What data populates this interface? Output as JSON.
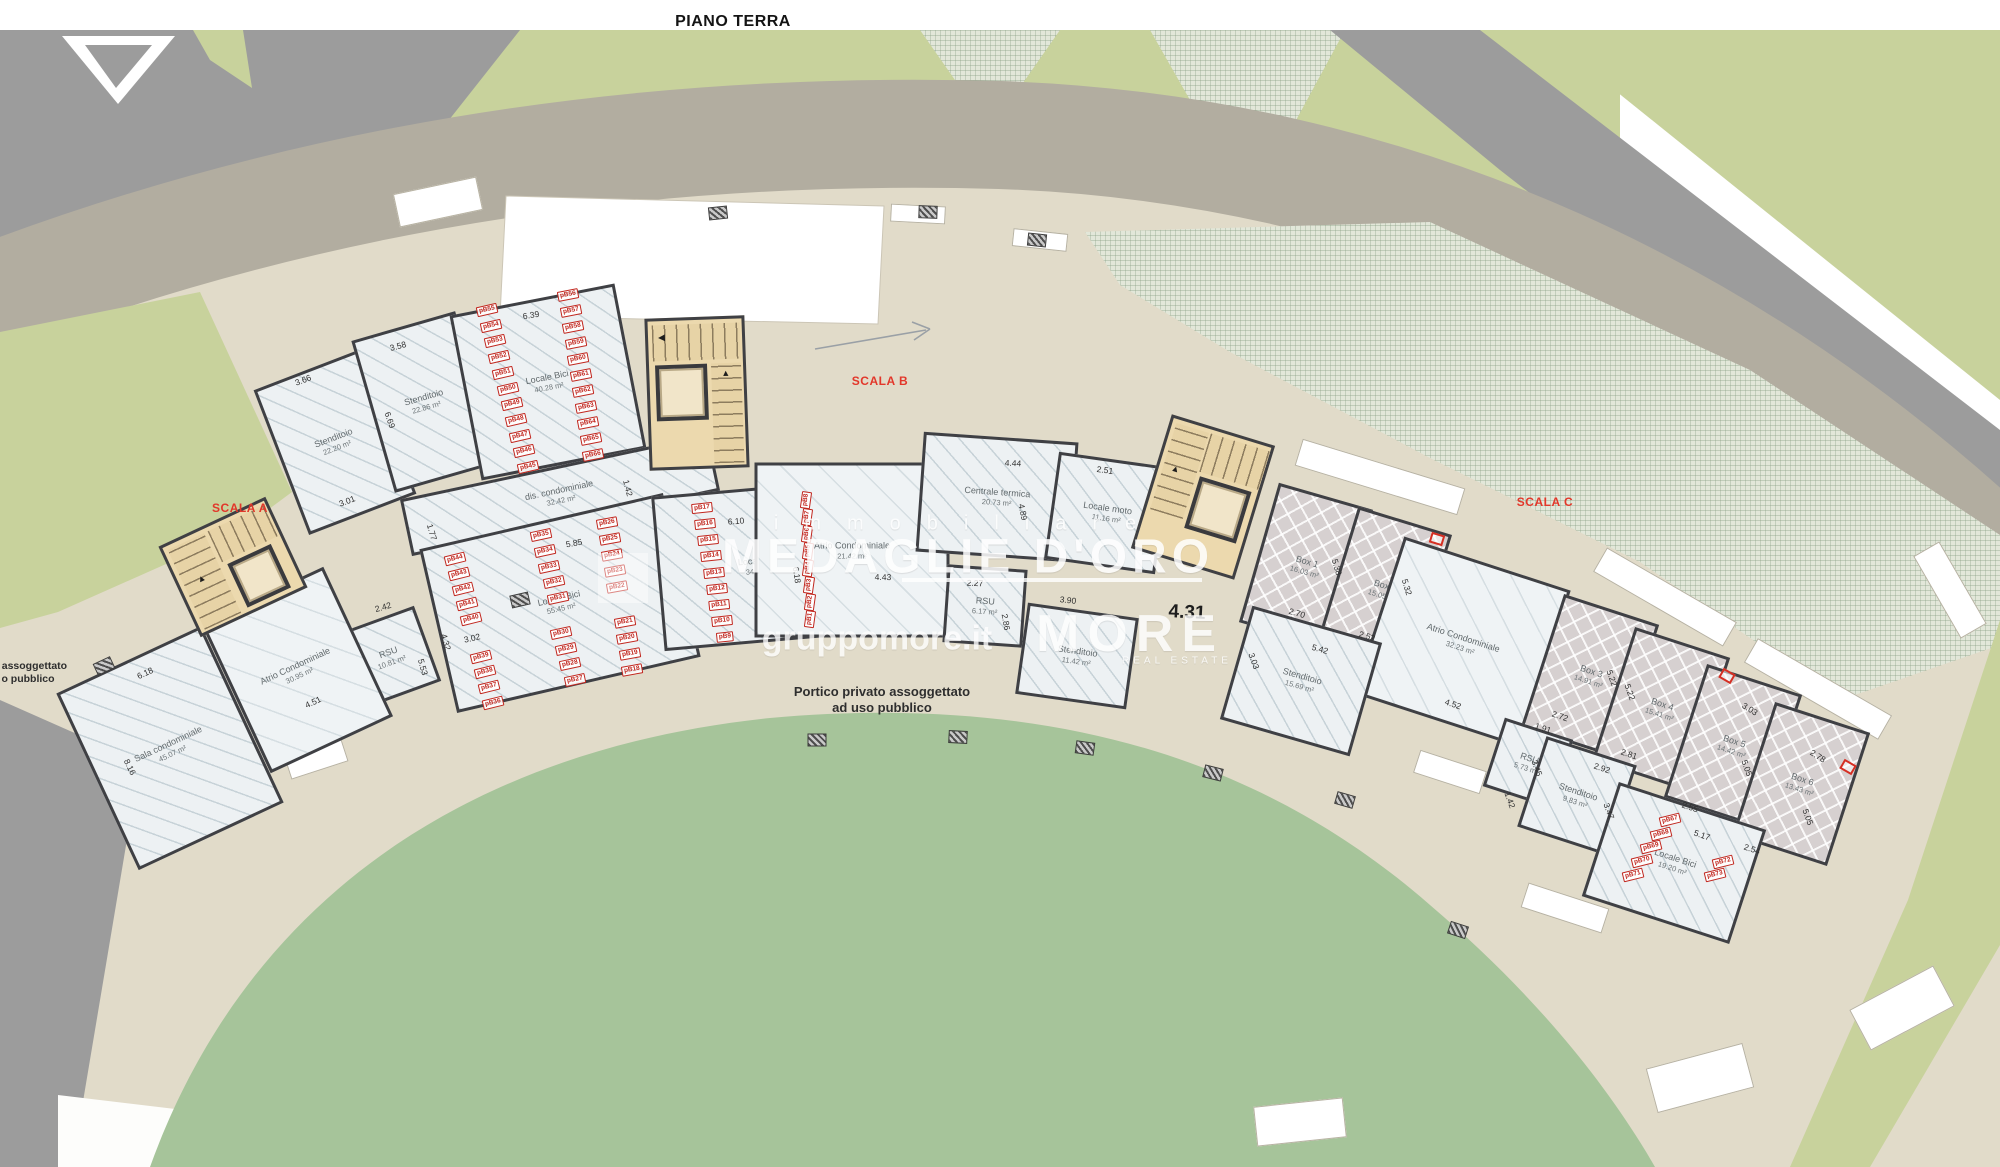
{
  "title": "PIANO TERRA",
  "watermark": {
    "immobiliare": "immobiliare",
    "brand_title": "MEDAGLIE D'ORO",
    "site": "gruppomore.it",
    "brand": "MORE",
    "brand_sub": "REAL ESTATE"
  },
  "colors": {
    "wall": "#3f4044",
    "road_gray": "#9c9c9c",
    "road_taupe": "#b2ada0",
    "ground_beige": "#e1dbc9",
    "lawn": "#a6c49a",
    "olive": "#c8d29c",
    "stair_tan": "#ecd9ae",
    "scala_red": "#e2372a",
    "tag_red": "#c1271f"
  },
  "plan": {
    "portico_note": {
      "line1": "Portico privato assoggettato",
      "line2": "ad uso pubblico"
    },
    "edge_note": {
      "line1": "to assoggettato",
      "line2": "o pubblico"
    },
    "big_dim": {
      "t": "4.31"
    },
    "scala_labels": [
      {
        "t": "SCALA A",
        "x": 240,
        "y": 508
      },
      {
        "t": "SCALA B",
        "x": 880,
        "y": 381
      },
      {
        "t": "SCALA C",
        "x": 1545,
        "y": 502
      }
    ],
    "rooms": [
      {
        "name": "Stenditoio",
        "area": "22.20 m²",
        "x": 335,
        "y": 442,
        "w": 115,
        "h": 155,
        "rot": -21,
        "cls": "hatch"
      },
      {
        "name": "Stenditoio",
        "area": "22.86 m²",
        "x": 425,
        "y": 402,
        "w": 108,
        "h": 158,
        "rot": -16,
        "cls": "hatch"
      },
      {
        "name": "Locale Bici",
        "area": "40.28 m²",
        "x": 548,
        "y": 382,
        "w": 168,
        "h": 168,
        "rot": -11,
        "cls": "hatch"
      },
      {
        "name": "dis. condominiale",
        "area": "32.42 m²",
        "x": 560,
        "y": 495,
        "w": 315,
        "h": 58,
        "rot": -12,
        "cls": "hatch"
      },
      {
        "name": "RSU",
        "area": "10.81 m²",
        "x": 390,
        "y": 657,
        "w": 80,
        "h": 80,
        "rot": -20,
        "cls": "hatch"
      },
      {
        "name": "Locale Bici",
        "area": "55.45 m²",
        "x": 560,
        "y": 603,
        "w": 250,
        "h": 168,
        "rot": -13,
        "cls": "hatch"
      },
      {
        "name": "Locale Bici",
        "area": "34.97 m²",
        "x": 760,
        "y": 565,
        "w": 205,
        "h": 155,
        "rot": -5,
        "cls": "hatch"
      },
      {
        "name": "Sala condominiale",
        "area": "45.07 m²",
        "x": 170,
        "y": 748,
        "w": 160,
        "h": 195,
        "rot": -25,
        "cls": "hatch"
      },
      {
        "name": "Atrio Condominiale",
        "area": "30.95 m²",
        "x": 297,
        "y": 670,
        "w": 135,
        "h": 165,
        "rot": -25,
        "cls": "atrio"
      },
      {
        "name": "Atrio Condominiale",
        "area": "21.42 m²",
        "x": 852,
        "y": 550,
        "w": 195,
        "h": 175,
        "rot": 0,
        "cls": "atrio"
      },
      {
        "name": "Centrale termica",
        "area": "20.73 m²",
        "x": 997,
        "y": 497,
        "w": 155,
        "h": 120,
        "rot": 4,
        "cls": "hatch"
      },
      {
        "name": "Locale moto",
        "area": "11.16 m²",
        "x": 1107,
        "y": 513,
        "w": 112,
        "h": 108,
        "rot": 8,
        "cls": "hatch"
      },
      {
        "name": "RSU",
        "area": "6.17 m²",
        "x": 985,
        "y": 606,
        "w": 80,
        "h": 78,
        "rot": 4,
        "cls": "hatch"
      },
      {
        "name": "Stenditoio",
        "area": "11.42 m²",
        "x": 1077,
        "y": 656,
        "w": 112,
        "h": 92,
        "rot": 8,
        "cls": "hatch"
      },
      {
        "name": "Box 1",
        "area": "16.03 m²",
        "x": 1306,
        "y": 566,
        "w": 98,
        "h": 145,
        "rot": 16,
        "cls": "box"
      },
      {
        "name": "Box 2",
        "area": "15.05 m²",
        "x": 1384,
        "y": 590,
        "w": 98,
        "h": 145,
        "rot": 17,
        "cls": "box"
      },
      {
        "name": "Atrio Condominiale",
        "area": "32.23 m²",
        "x": 1462,
        "y": 642,
        "w": 175,
        "h": 165,
        "rot": 18,
        "cls": "atrio"
      },
      {
        "name": "Stenditoio",
        "area": "15.69 m²",
        "x": 1301,
        "y": 681,
        "w": 135,
        "h": 118,
        "rot": 16,
        "cls": "hatch"
      },
      {
        "name": "Box 3",
        "area": "14.91 m²",
        "x": 1590,
        "y": 676,
        "w": 100,
        "h": 140,
        "rot": 18,
        "cls": "box"
      },
      {
        "name": "Box 4",
        "area": "15.41 m²",
        "x": 1661,
        "y": 709,
        "w": 100,
        "h": 140,
        "rot": 18,
        "cls": "box"
      },
      {
        "name": "Box 5",
        "area": "14.42 m²",
        "x": 1733,
        "y": 746,
        "w": 100,
        "h": 140,
        "rot": 18,
        "cls": "box"
      },
      {
        "name": "Box 6",
        "area": "13.43 m²",
        "x": 1801,
        "y": 784,
        "w": 100,
        "h": 140,
        "rot": 18,
        "cls": "box"
      },
      {
        "name": "RSU",
        "area": "5.73 m²",
        "x": 1528,
        "y": 763,
        "w": 72,
        "h": 72,
        "rot": 18,
        "cls": "hatch"
      },
      {
        "name": "Stenditoio",
        "area": "9.83 m²",
        "x": 1577,
        "y": 796,
        "w": 95,
        "h": 95,
        "rot": 18,
        "cls": "hatch"
      },
      {
        "name": "Locale Bici",
        "area": "19.20 m²",
        "x": 1674,
        "y": 863,
        "w": 155,
        "h": 120,
        "rot": 18,
        "cls": "hatch"
      }
    ],
    "dims": [
      {
        "t": "3.66",
        "x": 303,
        "y": 380,
        "rot": -21
      },
      {
        "t": "3.58",
        "x": 398,
        "y": 346,
        "rot": -15
      },
      {
        "t": "6.39",
        "x": 531,
        "y": 315,
        "rot": -9
      },
      {
        "t": "3.01",
        "x": 347,
        "y": 501,
        "rot": -21
      },
      {
        "t": "6.69",
        "x": 390,
        "y": 420,
        "rot": 71
      },
      {
        "t": "1.77",
        "x": 432,
        "y": 532,
        "rot": 73
      },
      {
        "t": "2.42",
        "x": 383,
        "y": 607,
        "rot": -16
      },
      {
        "t": "5.85",
        "x": 574,
        "y": 543,
        "rot": -10
      },
      {
        "t": "3.02",
        "x": 472,
        "y": 638,
        "rot": -13
      },
      {
        "t": "4.32",
        "x": 446,
        "y": 642,
        "rot": 74
      },
      {
        "t": "5.53",
        "x": 423,
        "y": 667,
        "rot": 74
      },
      {
        "t": "6.18",
        "x": 145,
        "y": 673,
        "rot": -25
      },
      {
        "t": "8.16",
        "x": 130,
        "y": 767,
        "rot": 64
      },
      {
        "t": "4.51",
        "x": 313,
        "y": 702,
        "rot": -25
      },
      {
        "t": "6.10",
        "x": 736,
        "y": 521,
        "rot": -4
      },
      {
        "t": "6.18",
        "x": 797,
        "y": 575,
        "rot": 82
      },
      {
        "t": "1.42",
        "x": 628,
        "y": 488,
        "rot": 75
      },
      {
        "t": "4.43",
        "x": 883,
        "y": 577,
        "rot": 1
      },
      {
        "t": "2.27",
        "x": 975,
        "y": 583,
        "rot": 3
      },
      {
        "t": "4.44",
        "x": 1013,
        "y": 463,
        "rot": 3
      },
      {
        "t": "2.51",
        "x": 1105,
        "y": 470,
        "rot": 8
      },
      {
        "t": "4.89",
        "x": 1023,
        "y": 512,
        "rot": 78
      },
      {
        "t": "3.90",
        "x": 1068,
        "y": 600,
        "rot": 6
      },
      {
        "t": "2.86",
        "x": 1006,
        "y": 622,
        "rot": 80
      },
      {
        "t": "2.70",
        "x": 1297,
        "y": 613,
        "rot": 16
      },
      {
        "t": "2.52",
        "x": 1367,
        "y": 636,
        "rot": 17
      },
      {
        "t": "5.42",
        "x": 1320,
        "y": 649,
        "rot": 16
      },
      {
        "t": "5.38",
        "x": 1337,
        "y": 567,
        "rot": 73
      },
      {
        "t": "5.32",
        "x": 1407,
        "y": 587,
        "rot": 73
      },
      {
        "t": "3.03",
        "x": 1254,
        "y": 661,
        "rot": 70
      },
      {
        "t": "4.52",
        "x": 1453,
        "y": 704,
        "rot": 18
      },
      {
        "t": "1.42",
        "x": 1510,
        "y": 800,
        "rot": 70
      },
      {
        "t": "1.91",
        "x": 1543,
        "y": 728,
        "rot": 18
      },
      {
        "t": "2.72",
        "x": 1560,
        "y": 716,
        "rot": 18
      },
      {
        "t": "2.92",
        "x": 1602,
        "y": 768,
        "rot": 18
      },
      {
        "t": "3.45",
        "x": 1537,
        "y": 768,
        "rot": 70
      },
      {
        "t": "3.47",
        "x": 1609,
        "y": 811,
        "rot": 70
      },
      {
        "t": "5.22",
        "x": 1612,
        "y": 678,
        "rot": 70
      },
      {
        "t": "5.22",
        "x": 1630,
        "y": 692,
        "rot": 70
      },
      {
        "t": "2.81",
        "x": 1629,
        "y": 754,
        "rot": 18
      },
      {
        "t": "2.55",
        "x": 1690,
        "y": 807,
        "rot": 18
      },
      {
        "t": "5.17",
        "x": 1702,
        "y": 835,
        "rot": 18
      },
      {
        "t": "2.54",
        "x": 1752,
        "y": 849,
        "rot": 18
      },
      {
        "t": "3.03",
        "x": 1750,
        "y": 709,
        "rot": 32
      },
      {
        "t": "2.78",
        "x": 1818,
        "y": 756,
        "rot": 32
      },
      {
        "t": "5.05",
        "x": 1747,
        "y": 768,
        "rot": 70
      },
      {
        "t": "5.05",
        "x": 1808,
        "y": 817,
        "rot": 70
      }
    ],
    "parking_tags": [
      {
        "t": "pB55",
        "x": 487,
        "y": 310,
        "rot": -13
      },
      {
        "t": "pB54",
        "x": 491,
        "y": 326,
        "rot": -13
      },
      {
        "t": "pB53",
        "x": 495,
        "y": 341,
        "rot": -13
      },
      {
        "t": "pB52",
        "x": 499,
        "y": 357,
        "rot": -13
      },
      {
        "t": "pB51",
        "x": 503,
        "y": 373,
        "rot": -13
      },
      {
        "t": "pB50",
        "x": 508,
        "y": 389,
        "rot": -13
      },
      {
        "t": "pB49",
        "x": 512,
        "y": 404,
        "rot": -13
      },
      {
        "t": "pB48",
        "x": 516,
        "y": 420,
        "rot": -13
      },
      {
        "t": "pB47",
        "x": 520,
        "y": 436,
        "rot": -13
      },
      {
        "t": "pB46",
        "x": 524,
        "y": 451,
        "rot": -13
      },
      {
        "t": "pB45",
        "x": 528,
        "y": 467,
        "rot": -13
      },
      {
        "t": "pB56",
        "x": 568,
        "y": 295,
        "rot": -11
      },
      {
        "t": "pB57",
        "x": 571,
        "y": 311,
        "rot": -11
      },
      {
        "t": "pB58",
        "x": 573,
        "y": 327,
        "rot": -11
      },
      {
        "t": "pB59",
        "x": 576,
        "y": 343,
        "rot": -11
      },
      {
        "t": "pB60",
        "x": 578,
        "y": 359,
        "rot": -11
      },
      {
        "t": "pB61",
        "x": 581,
        "y": 375,
        "rot": -11
      },
      {
        "t": "pB62",
        "x": 583,
        "y": 391,
        "rot": -11
      },
      {
        "t": "pB63",
        "x": 586,
        "y": 407,
        "rot": -11
      },
      {
        "t": "pB64",
        "x": 588,
        "y": 423,
        "rot": -11
      },
      {
        "t": "pB65",
        "x": 591,
        "y": 439,
        "rot": -11
      },
      {
        "t": "pB66",
        "x": 593,
        "y": 455,
        "rot": -11
      },
      {
        "t": "pB44",
        "x": 455,
        "y": 559,
        "rot": -14
      },
      {
        "t": "pB43",
        "x": 459,
        "y": 574,
        "rot": -14
      },
      {
        "t": "pB42",
        "x": 463,
        "y": 589,
        "rot": -14
      },
      {
        "t": "pB41",
        "x": 467,
        "y": 604,
        "rot": -14
      },
      {
        "t": "pB40",
        "x": 471,
        "y": 619,
        "rot": -14
      },
      {
        "t": "pB39",
        "x": 481,
        "y": 657,
        "rot": -14
      },
      {
        "t": "pB38",
        "x": 485,
        "y": 672,
        "rot": -14
      },
      {
        "t": "pB37",
        "x": 489,
        "y": 687,
        "rot": -14
      },
      {
        "t": "pB36",
        "x": 493,
        "y": 703,
        "rot": -14
      },
      {
        "t": "pB35",
        "x": 541,
        "y": 535,
        "rot": -12
      },
      {
        "t": "pB34",
        "x": 545,
        "y": 551,
        "rot": -12
      },
      {
        "t": "pB33",
        "x": 549,
        "y": 567,
        "rot": -12
      },
      {
        "t": "pB32",
        "x": 554,
        "y": 582,
        "rot": -12
      },
      {
        "t": "pB31",
        "x": 558,
        "y": 598,
        "rot": -12
      },
      {
        "t": "pB30",
        "x": 561,
        "y": 633,
        "rot": -12
      },
      {
        "t": "pB29",
        "x": 566,
        "y": 649,
        "rot": -12
      },
      {
        "t": "pB28",
        "x": 570,
        "y": 664,
        "rot": -12
      },
      {
        "t": "pB27",
        "x": 575,
        "y": 680,
        "rot": -12
      },
      {
        "t": "pB26",
        "x": 607,
        "y": 523,
        "rot": -10
      },
      {
        "t": "pB25",
        "x": 610,
        "y": 539,
        "rot": -10
      },
      {
        "t": "pB24",
        "x": 612,
        "y": 555,
        "rot": -10
      },
      {
        "t": "pB23",
        "x": 615,
        "y": 571,
        "rot": -10
      },
      {
        "t": "pB22",
        "x": 617,
        "y": 587,
        "rot": -10
      },
      {
        "t": "pB21",
        "x": 625,
        "y": 622,
        "rot": -10
      },
      {
        "t": "pB20",
        "x": 627,
        "y": 638,
        "rot": -10
      },
      {
        "t": "pB19",
        "x": 630,
        "y": 654,
        "rot": -10
      },
      {
        "t": "pB18",
        "x": 632,
        "y": 670,
        "rot": -10
      },
      {
        "t": "pB17",
        "x": 702,
        "y": 508,
        "rot": -6
      },
      {
        "t": "pB16",
        "x": 705,
        "y": 524,
        "rot": -6
      },
      {
        "t": "pB15",
        "x": 708,
        "y": 540,
        "rot": -6
      },
      {
        "t": "pB14",
        "x": 711,
        "y": 556,
        "rot": -6
      },
      {
        "t": "pB13",
        "x": 714,
        "y": 573,
        "rot": -6
      },
      {
        "t": "pB12",
        "x": 717,
        "y": 589,
        "rot": -6
      },
      {
        "t": "pB11",
        "x": 719,
        "y": 605,
        "rot": -6
      },
      {
        "t": "pB10",
        "x": 722,
        "y": 621,
        "rot": -6
      },
      {
        "t": "pB9",
        "x": 725,
        "y": 637,
        "rot": -6
      },
      {
        "t": "pB8",
        "x": 806,
        "y": 500,
        "rot": -82
      },
      {
        "t": "pB7",
        "x": 807,
        "y": 517,
        "rot": -82
      },
      {
        "t": "pB6",
        "x": 807,
        "y": 534,
        "rot": -82
      },
      {
        "t": "pB5",
        "x": 808,
        "y": 551,
        "rot": -82
      },
      {
        "t": "pB4",
        "x": 808,
        "y": 568,
        "rot": -82
      },
      {
        "t": "pB3",
        "x": 809,
        "y": 585,
        "rot": -82
      },
      {
        "t": "pB2",
        "x": 810,
        "y": 602,
        "rot": -82
      },
      {
        "t": "pB1",
        "x": 810,
        "y": 619,
        "rot": -82
      },
      {
        "t": "pB67",
        "x": 1670,
        "y": 820,
        "rot": -14
      },
      {
        "t": "pB68",
        "x": 1661,
        "y": 834,
        "rot": -14
      },
      {
        "t": "pB69",
        "x": 1651,
        "y": 847,
        "rot": -14
      },
      {
        "t": "pB70",
        "x": 1642,
        "y": 861,
        "rot": -14
      },
      {
        "t": "pB71",
        "x": 1633,
        "y": 875,
        "rot": -14
      },
      {
        "t": "pB72",
        "x": 1723,
        "y": 862,
        "rot": -14
      },
      {
        "t": "pB73",
        "x": 1715,
        "y": 875,
        "rot": -14
      }
    ]
  }
}
